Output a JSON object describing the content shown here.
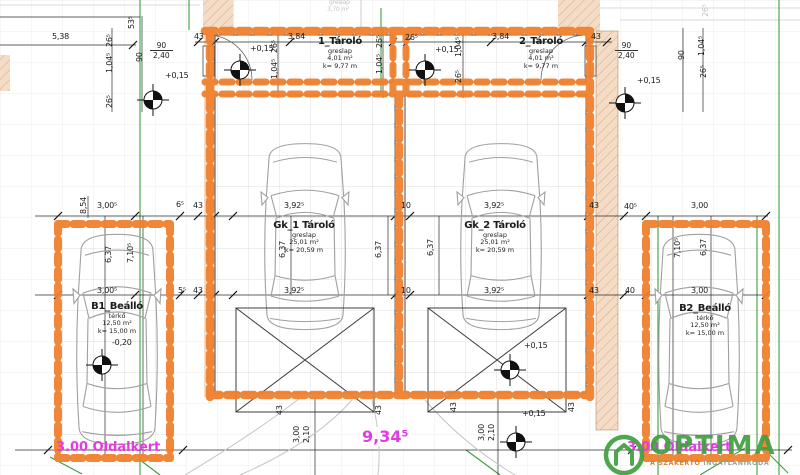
{
  "colors": {
    "wall_highlight": "#f0812e",
    "masonry_fill": "#f5dcc6",
    "annotation": "#1c1c1c",
    "site_text_magenta": "#e13ce1",
    "boundary_green": "#3c9e3c",
    "logo_green": "#41a041"
  },
  "rooms": {
    "storage1": {
      "name": "1_Tároló",
      "floor": "greslap",
      "area": "4,01 m²",
      "perimeter": "k= 9,77 m"
    },
    "storage2": {
      "name": "2_Tároló",
      "floor": "greslap",
      "area": "4,01 m²",
      "perimeter": "k= 9,77 m"
    },
    "garage1": {
      "name": "Gk_1 Tároló",
      "floor": "greslap",
      "area": "25,01 m²",
      "perimeter": "k= 20,59 m"
    },
    "garage2": {
      "name": "Gk_2 Tároló",
      "floor": "greslap",
      "area": "25,01 m²",
      "perimeter": "k= 20,59 m"
    },
    "carport1": {
      "name": "B1_Beálló",
      "floor": "térkő",
      "area": "12,50 m²",
      "perimeter": "k= 15,00 m"
    },
    "carport2": {
      "name": "B2_Beálló",
      "floor": "térkő",
      "area": "12,50 m²",
      "perimeter": "k= 15,00 m"
    },
    "upper_faded": {
      "floor": "greslap",
      "area": "3,70 m²"
    }
  },
  "levels": {
    "plus015": "+0,15",
    "minus020": "-0,20"
  },
  "dims": {
    "d538": "5,38",
    "d535": "53⁵",
    "d265": "26⁵",
    "d1045": "1,04⁵",
    "d90": "90",
    "d240": "2,40",
    "d43": "43",
    "d384": "3,84",
    "d854": "8,54",
    "d3005": "3,00⁵",
    "d65": "6⁵",
    "d55": "5⁵",
    "d3925": "3,92⁵",
    "d10": "10",
    "d405": "40⁵",
    "d40": "40",
    "d300": "3,00",
    "d637": "6,37",
    "d7105": "7,10⁵",
    "d210": "2,10",
    "d9345": "9,34⁵"
  },
  "site": {
    "left_side_garden": "3.00 Oldalkert",
    "right_side_garden": "3.00 Oldalkert"
  },
  "logo": {
    "brand": "OPTIMA",
    "tagline1": "A SZAKÉRTŐ",
    "tagline2": "INGATLANIRODA"
  }
}
